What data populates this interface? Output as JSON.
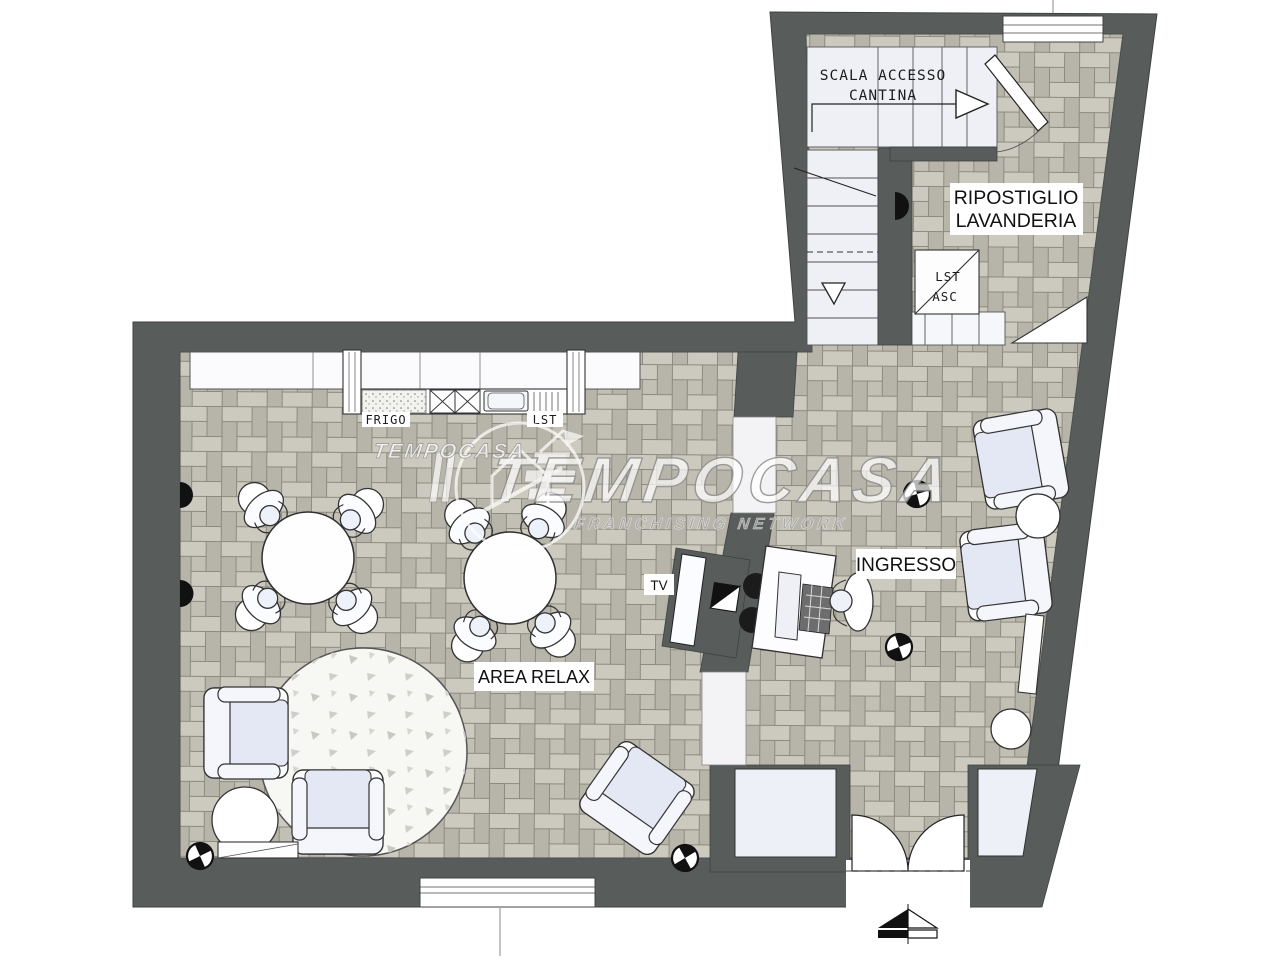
{
  "plan": {
    "colors": {
      "wall": "#585c5a",
      "floor_base": "#c3c0b5",
      "floor_plank_light": "#ccc9be",
      "floor_plank_dark": "#b7b4a9",
      "floor_line": "#8d8a80",
      "stair_fill": "#eef0f6",
      "furniture_fill": "#fdfdfe",
      "furniture_shade": "#e4e8f4",
      "rug_fill": "#f7f7f3",
      "outline": "#2f2f2f",
      "label_bg": "#ffffff",
      "label_text": "#111111"
    },
    "labels": {
      "stairs_line1": "SCALA ACCESSO",
      "stairs_line2": "CANTINA",
      "storage_line1": "RIPOSTIGLIO",
      "storage_line2": "LAVANDERIA",
      "lift_line1": "LST",
      "lift_line2": "ASC",
      "fridge": "FRIGO",
      "dishwasher": "LST",
      "tv": "TV",
      "entrance": "INGRESSO",
      "relax": "AREA RELAX"
    }
  },
  "watermark": {
    "brand": "TEMPOCASA",
    "brand_small": "TEMPOCASA",
    "tagline": "FRANCHISING NETWORK"
  }
}
